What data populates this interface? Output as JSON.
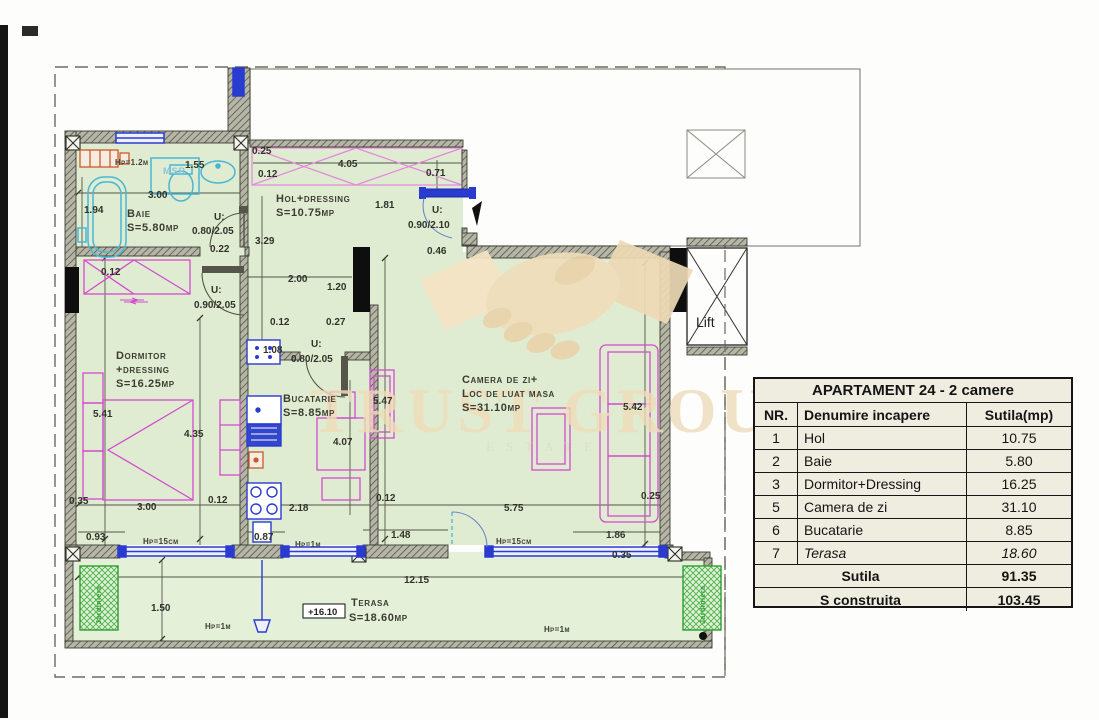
{
  "watermark": {
    "text": "TRUST GROUP",
    "subtext": "ESTATE"
  },
  "table": {
    "title": "APARTAMENT 24 - 2 camere",
    "columns": [
      "NR.",
      "Denumire incapere",
      "Sutila(mp)"
    ],
    "rows": [
      [
        "1",
        "Hol",
        "10.75"
      ],
      [
        "2",
        "Baie",
        "5.80"
      ],
      [
        "3",
        "Dormitor+Dressing",
        "16.25"
      ],
      [
        "5",
        "Camera de zi",
        "31.10"
      ],
      [
        "6",
        "Bucatarie",
        "8.85"
      ],
      [
        "7",
        "Terasa",
        "18.60"
      ]
    ],
    "italic_row": "Terasa",
    "footer": [
      [
        "Sutila",
        "91.35"
      ],
      [
        "S construita",
        "103.45"
      ]
    ]
  },
  "plan": {
    "colors": {
      "room_fill": "#dfecd2",
      "terrace_fill": "#e4f0d8",
      "wall": "#3a3a32",
      "furniture": "#d44ad0",
      "fixture": "#49b6d2",
      "window": "#2a3bd0",
      "radiator": "#cc5a28",
      "planter": "#2f9e2f",
      "watermark": "#eedcb9"
    },
    "room_labels": [
      {
        "t": "Baie",
        "x": 127,
        "y": 217
      },
      {
        "t": "S=5.80mp",
        "x": 127,
        "y": 231
      },
      {
        "t": "Hol+dressing",
        "x": 276,
        "y": 202
      },
      {
        "t": "S=10.75mp",
        "x": 276,
        "y": 216
      },
      {
        "t": "Dormitor",
        "x": 116,
        "y": 359
      },
      {
        "t": "+dressing",
        "x": 116,
        "y": 373
      },
      {
        "t": "S=16.25mp",
        "x": 116,
        "y": 387
      },
      {
        "t": "Bucatarie",
        "x": 283,
        "y": 402
      },
      {
        "t": "S=8.85mp",
        "x": 283,
        "y": 416
      },
      {
        "t": "Camera de zi+",
        "x": 462,
        "y": 383
      },
      {
        "t": "Loc de luat masa",
        "x": 462,
        "y": 397
      },
      {
        "t": "S=31.10mp",
        "x": 462,
        "y": 411
      },
      {
        "t": "Terasa",
        "x": 351,
        "y": 606
      },
      {
        "t": "S=18.60mp",
        "x": 349,
        "y": 621
      }
    ],
    "dim_labels": [
      {
        "t": "0.25",
        "x": 252,
        "y": 154
      },
      {
        "t": "0.12",
        "x": 258,
        "y": 177
      },
      {
        "t": "4.05",
        "x": 338,
        "y": 167
      },
      {
        "t": "0.71",
        "x": 426,
        "y": 176
      },
      {
        "t": "1.81",
        "x": 375,
        "y": 208
      },
      {
        "t": "U:",
        "x": 432,
        "y": 213
      },
      {
        "t": "0.90/2.10",
        "x": 408,
        "y": 228
      },
      {
        "t": "0.46",
        "x": 427,
        "y": 254
      },
      {
        "t": "1.55",
        "x": 185,
        "y": 168
      },
      {
        "t": "3.00",
        "x": 148,
        "y": 198
      },
      {
        "t": "1.94",
        "x": 84,
        "y": 213
      },
      {
        "t": "U:",
        "x": 214,
        "y": 220
      },
      {
        "t": "0.80/2.05",
        "x": 192,
        "y": 234
      },
      {
        "t": "0.22",
        "x": 210,
        "y": 252
      },
      {
        "t": "3.29",
        "x": 255,
        "y": 244
      },
      {
        "t": "2.00",
        "x": 288,
        "y": 282
      },
      {
        "t": "1.20",
        "x": 327,
        "y": 290
      },
      {
        "t": "0.12",
        "x": 270,
        "y": 325
      },
      {
        "t": "0.27",
        "x": 326,
        "y": 325
      },
      {
        "t": "0.12",
        "x": 101,
        "y": 275
      },
      {
        "t": "U:",
        "x": 211,
        "y": 293
      },
      {
        "t": "0.90/2.05",
        "x": 194,
        "y": 308
      },
      {
        "t": "1.08",
        "x": 263,
        "y": 353
      },
      {
        "t": "U:",
        "x": 311,
        "y": 347
      },
      {
        "t": "0.80/2.05",
        "x": 291,
        "y": 362
      },
      {
        "t": "5.41",
        "x": 93,
        "y": 417
      },
      {
        "t": "4.35",
        "x": 184,
        "y": 437
      },
      {
        "t": "4.07",
        "x": 333,
        "y": 445
      },
      {
        "t": "5.47",
        "x": 373,
        "y": 404
      },
      {
        "t": "5.42",
        "x": 623,
        "y": 410
      },
      {
        "t": "0.35",
        "x": 69,
        "y": 504
      },
      {
        "t": "3.00",
        "x": 137,
        "y": 510
      },
      {
        "t": "0.12",
        "x": 208,
        "y": 503
      },
      {
        "t": "2.18",
        "x": 289,
        "y": 511
      },
      {
        "t": "0.12",
        "x": 376,
        "y": 501
      },
      {
        "t": "5.75",
        "x": 504,
        "y": 511
      },
      {
        "t": "0.25",
        "x": 641,
        "y": 499
      },
      {
        "t": "0.93",
        "x": 86,
        "y": 540
      },
      {
        "t": "0.87",
        "x": 254,
        "y": 540
      },
      {
        "t": "1.48",
        "x": 391,
        "y": 538
      },
      {
        "t": "1.86",
        "x": 606,
        "y": 538
      },
      {
        "t": "0.35",
        "x": 612,
        "y": 558
      },
      {
        "t": "12.15",
        "x": 404,
        "y": 583
      },
      {
        "t": "1.50",
        "x": 151,
        "y": 611
      }
    ],
    "hp_labels": [
      {
        "t": "Hp=1.2m",
        "x": 115,
        "y": 165
      },
      {
        "t": "Hp=15cm",
        "x": 143,
        "y": 544
      },
      {
        "t": "Hp=1m",
        "x": 295,
        "y": 547
      },
      {
        "t": "Hp=15cm",
        "x": 496,
        "y": 544
      },
      {
        "t": "Hp=1m",
        "x": 205,
        "y": 629
      },
      {
        "t": "Hp=1m",
        "x": 544,
        "y": 632
      }
    ],
    "msr_label": {
      "t": "MSR",
      "x": 163,
      "y": 174
    },
    "lift_label": {
      "t": "Lift",
      "x": 696,
      "y": 327
    },
    "elev_label": {
      "t": "+16.10",
      "x": 308,
      "y": 615
    },
    "jardiniera_labels": [
      {
        "t": "Jardiniera",
        "x": 101,
        "y": 624,
        "rot": -90
      },
      {
        "t": "Jardiniera",
        "x": 705,
        "y": 624,
        "rot": -90
      }
    ]
  }
}
